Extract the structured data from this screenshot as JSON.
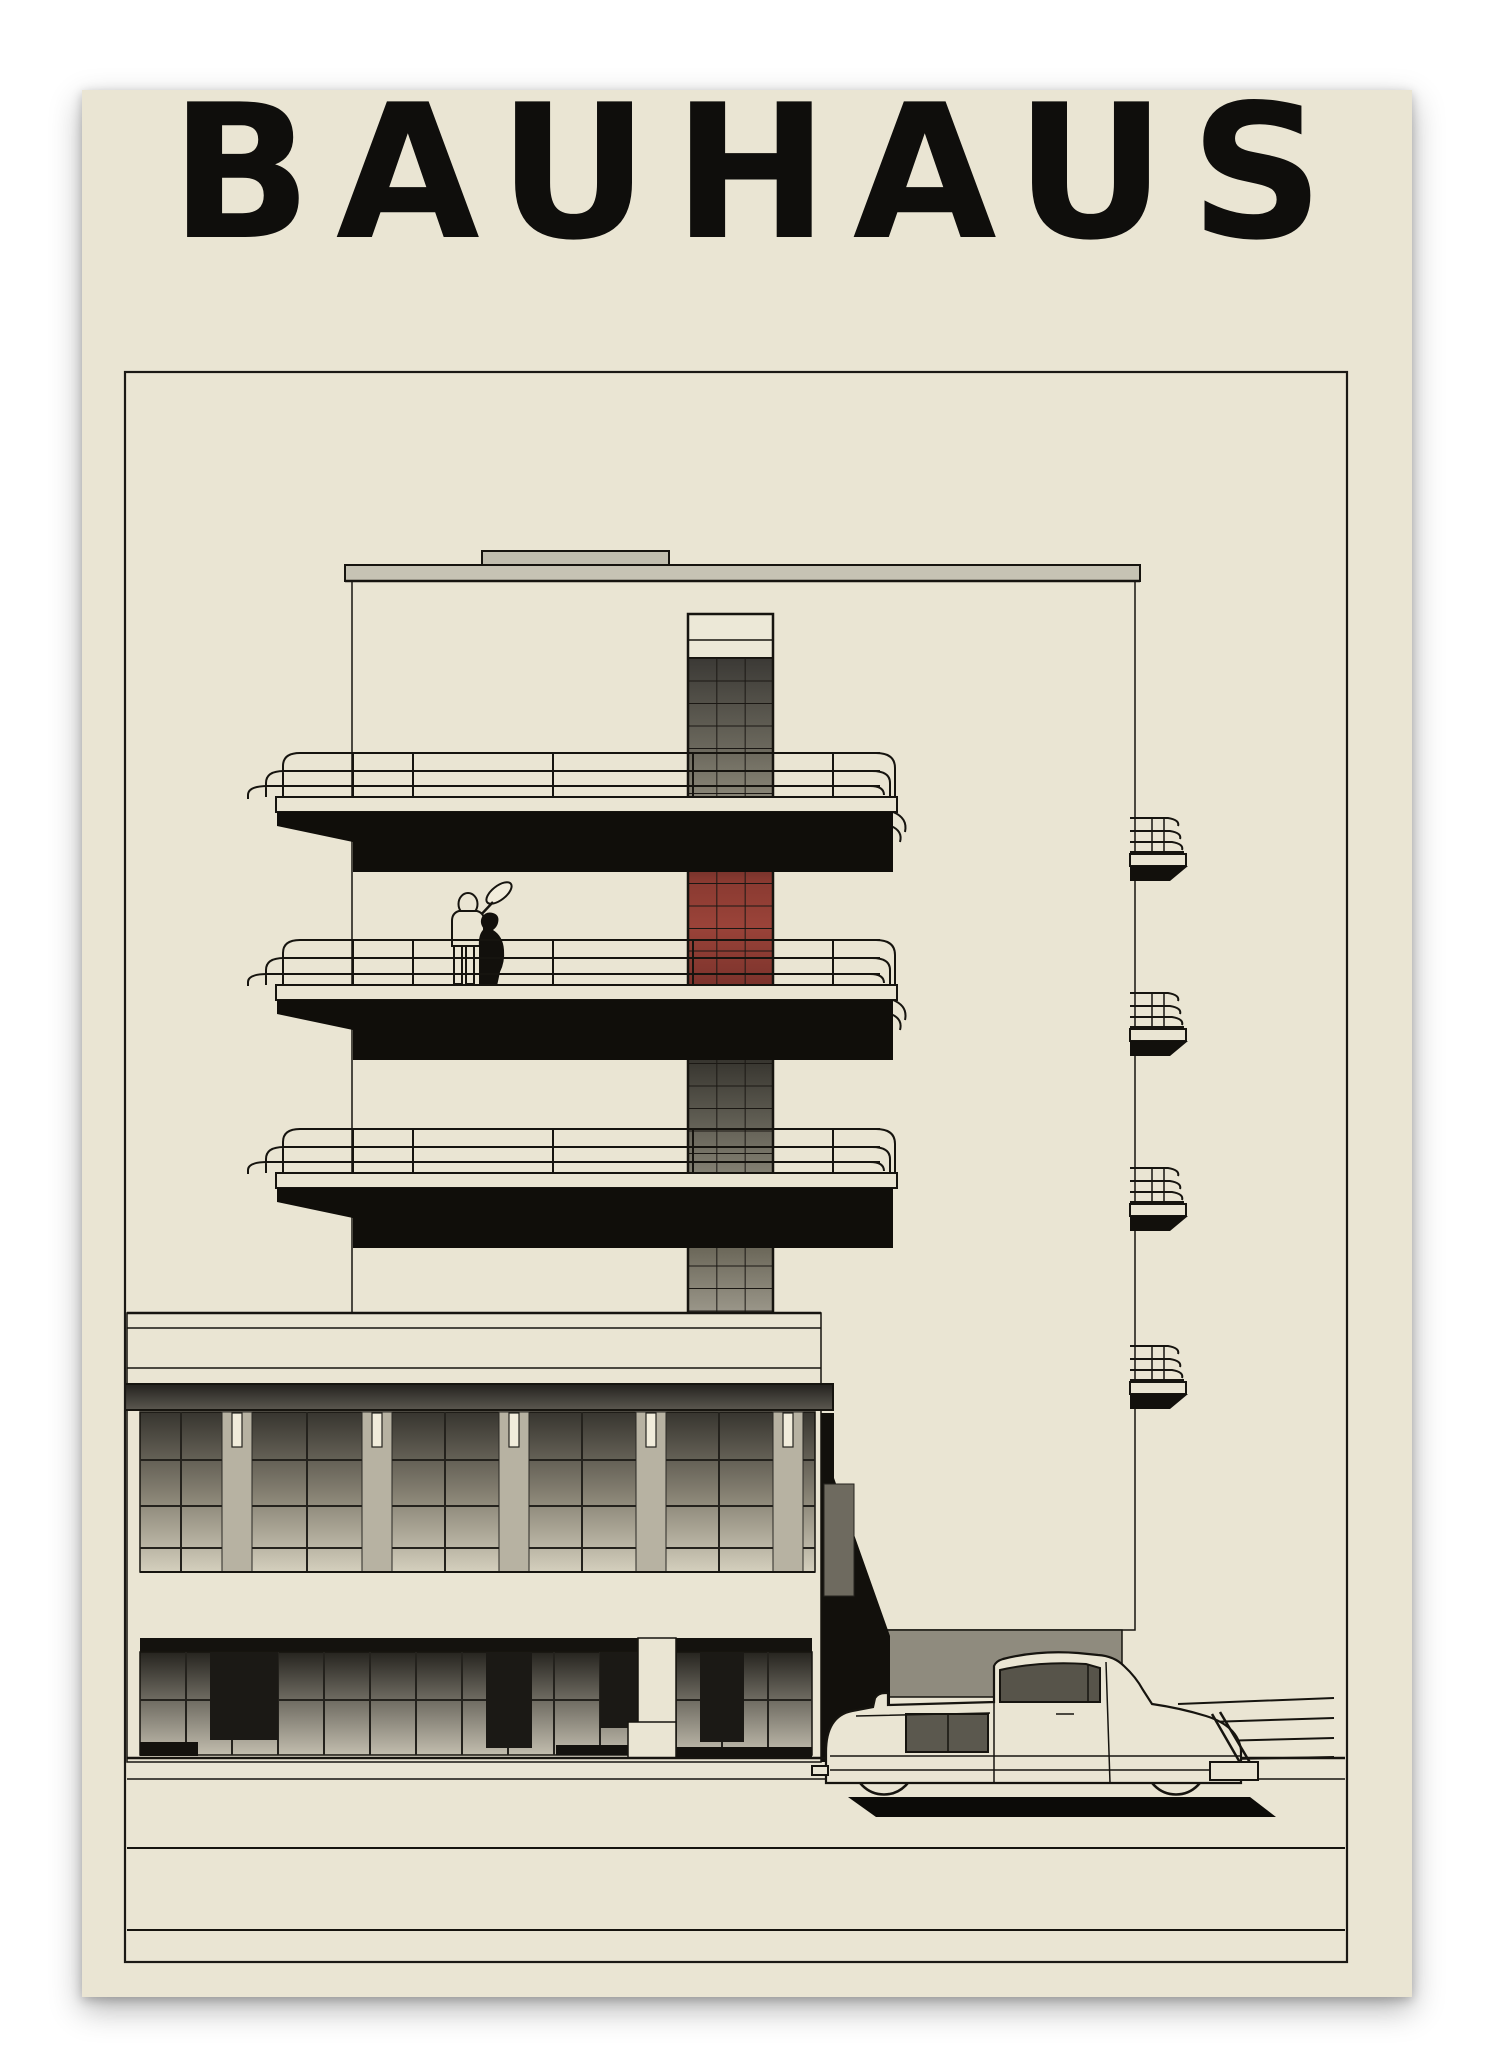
{
  "poster": {
    "title": "BAUHAUS",
    "subject": "Minimalist architectural illustration of the Bauhaus Dessau building with a vintage convertible car parked on the street and two figures standing on a balcony",
    "medium": "art print on cream paper, framed by a thin black border"
  },
  "scene": {
    "building": "white modernist facade with flat roof, three long tubular-railing balconies, glazed stair tower, two-storey lower wing with pilaster windows and a dark storefront",
    "stair_tower": "grid-glazed tower, grey glass above, red glass panel between the upper balconies",
    "figures": "one light outlined figure blowing a horn and one dark silhouetted figure on the second balcony",
    "side_balconies": "four small curved-rail balconies on the right facade edge",
    "car": "1930s cream convertible coupe with black outlines, parked in front of the dark underpass",
    "street": "horizontal sidewalk and road lines across the bottom of the frame"
  },
  "palette": {
    "page_background": "#ffffff",
    "poster_cream": "#eae5d3",
    "ink_black": "#16140f",
    "deep_black": "#100e0a",
    "accent_red": "#9a4339",
    "roof_grey": "#c6c3b4",
    "pilaster_grey": "#b7b2a2",
    "underpass_grey": "#8f8b7e",
    "glass_dark": "#3a3833"
  }
}
